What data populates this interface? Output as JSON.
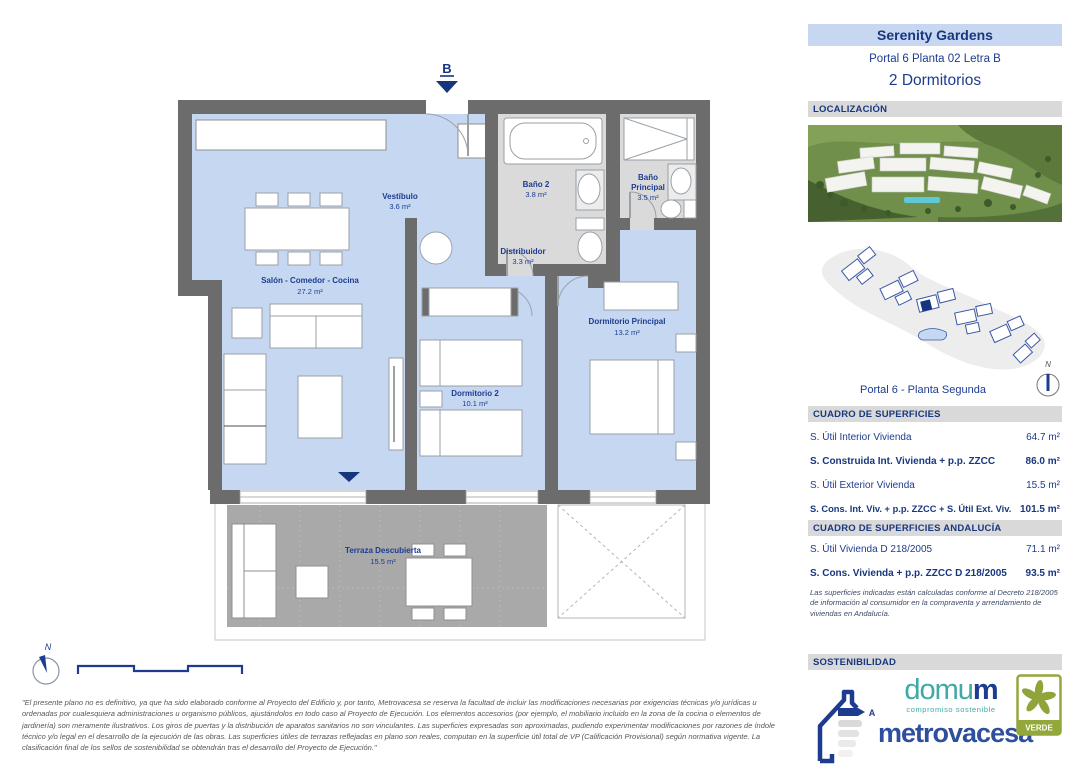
{
  "header": {
    "project": "Serenity Gardens",
    "unit": "Portal 6 Planta 02 Letra B",
    "type": "2 Dormitorios"
  },
  "section_labels": {
    "localizacion": "LOCALIZACIÓN",
    "cuadro": "CUADRO DE SUPERFICIES",
    "cuadro_andalucia": "CUADRO DE SUPERFICIES ANDALUCÍA",
    "sostenibilidad": "SOSTENIBILIDAD"
  },
  "siteplan": {
    "caption": "Portal 6 - Planta Segunda",
    "north": "N"
  },
  "plan": {
    "entrance_label": "B",
    "north": "N"
  },
  "rooms": [
    {
      "name": "Vestíbulo",
      "area": "3.6 m²"
    },
    {
      "name": "Baño 2",
      "area": "3.8 m²"
    },
    {
      "name": "Baño Principal",
      "name_l1": "Baño",
      "name_l2": "Principal",
      "area": "3.5 m²"
    },
    {
      "name": "Distribuidor",
      "area": "3.3 m²"
    },
    {
      "name": "Salón - Comedor - Cocina",
      "area": "27.2 m²"
    },
    {
      "name": "Dormitorio 2",
      "area": "10.1 m²"
    },
    {
      "name": "Dormitorio Principal",
      "area": "13.2 m²"
    },
    {
      "name": "Terraza Descubierta",
      "area": "15.5 m²"
    }
  ],
  "surfaces": {
    "rows": [
      {
        "label": "S. Útil Interior Vivienda",
        "value": "64.7 m²"
      },
      {
        "label": "S. Construida Int. Vivienda + p.p. ZZCC",
        "value": "86.0 m²"
      },
      {
        "label": "S. Útil Exterior Vivienda",
        "value": "15.5 m²"
      },
      {
        "label": "S. Cons. Int. Viv. + p.p. ZZCC + S. Útil Ext. Viv.",
        "value": "101.5 m²"
      }
    ]
  },
  "andalucia": {
    "rows": [
      {
        "label": "S. Útil Vivienda D 218/2005",
        "value": "71.1 m²"
      },
      {
        "label": "S. Cons. Vivienda + p.p. ZZCC D 218/2005",
        "value": "93.5 m²"
      }
    ],
    "note": "Las superficies indicadas están calculadas conforme al Decreto 218/2005 de información al consumidor en la compraventa y arrendamiento de viviendas en Andalucía."
  },
  "logos": {
    "energy_rating": "A",
    "domum_part1": "domu",
    "domum_part2": "m",
    "domum_tagline": "compromiso sostenible",
    "metrovacesa": "metrovacesa",
    "verde": "VERDE"
  },
  "footer": {
    "north": "N"
  },
  "disclaimer": "\"El presente plano no es definitivo, ya que ha sido elaborado conforme al Proyecto del Edificio y, por tanto, Metrovacesa se reserva la facultad de incluir las modificaciones necesarias por exigencias técnicas y/o jurídicas u ordenadas por cualesquiera administraciones u organismo públicos, ajustándolos en todo caso al Proyecto de Ejecución. Los elementos accesorios (por ejemplo, el mobiliario incluido en la zona de la cocina o elementos de jardinería) son meramente ilustrativos. Los giros de puertas y la distribución de aparatos sanitarios no son vinculantes. Las superficies expresadas son aproximadas, pudiendo experimentar modificaciones por razones de índole técnico y/o legal en el desarrollo de la ejecución de las obras. Las superficies útiles de terrazas reflejadas en plano son reales, computan en la superficie útil total de VP (Calificación Provisional) según normativa vigente. La clasificación final de los sellos de sostenibilidad se obtendrán tras el desarrollo del Proyecto de Ejecución.\"",
  "colors": {
    "accent_navy": "#1d3c8f",
    "room_blue": "#c6d8f1",
    "bath_gray": "#d9d9d9",
    "terrace_gray": "#a9a9a9",
    "wall_gray": "#6c6c6c",
    "bar_gray": "#d9d9d9",
    "title_bg": "#c7d7f1",
    "domum_teal": "#3fa9a5",
    "verde_green": "#93a83b"
  }
}
